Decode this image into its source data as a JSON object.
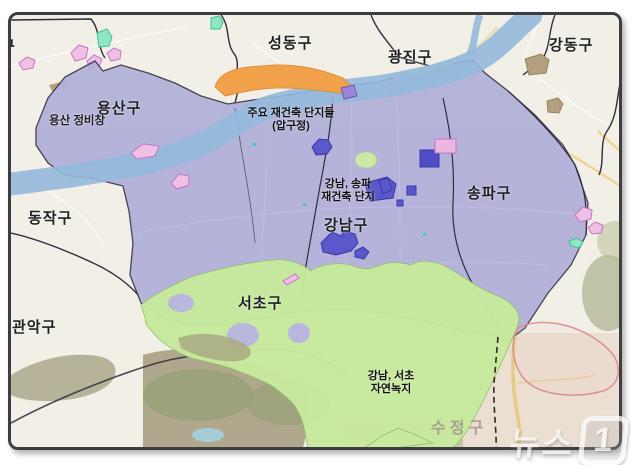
{
  "map": {
    "district_labels": {
      "partial_left": "구",
      "seongdong": "성동구",
      "gwangjin": "광진구",
      "gangdong": "강동구",
      "yongsan": "용산구",
      "dongjak": "동작구",
      "gwanak": "관악구",
      "seocho": "서초구",
      "gangnam": "강남구",
      "songpa": "송파구",
      "sujeong": "수정구"
    },
    "annotations": {
      "yongsan_depot": "용산 정비창",
      "apgujeong_line1": "주요 재건축 단지들",
      "apgujeong_line2": "(압구정)",
      "redev_line1": "강남, 송파",
      "redev_line2": "재건축 단지",
      "greenbelt_line1": "강남, 서초",
      "greenbelt_line2": "자연녹지"
    },
    "legend_colors": {
      "highlight_overlay": "#b2b0d9",
      "greenbelt_overlay": "#c7ea9d",
      "apgujeong_orange": "#f1a149",
      "river_blue": "#97b9dc",
      "redev_complex_blue": "#5b58cb",
      "redev_complex_pink": "#edb6e0",
      "base_map": "#f2efe6"
    }
  },
  "watermark": {
    "brand": "뉴스",
    "numeral": "1"
  }
}
